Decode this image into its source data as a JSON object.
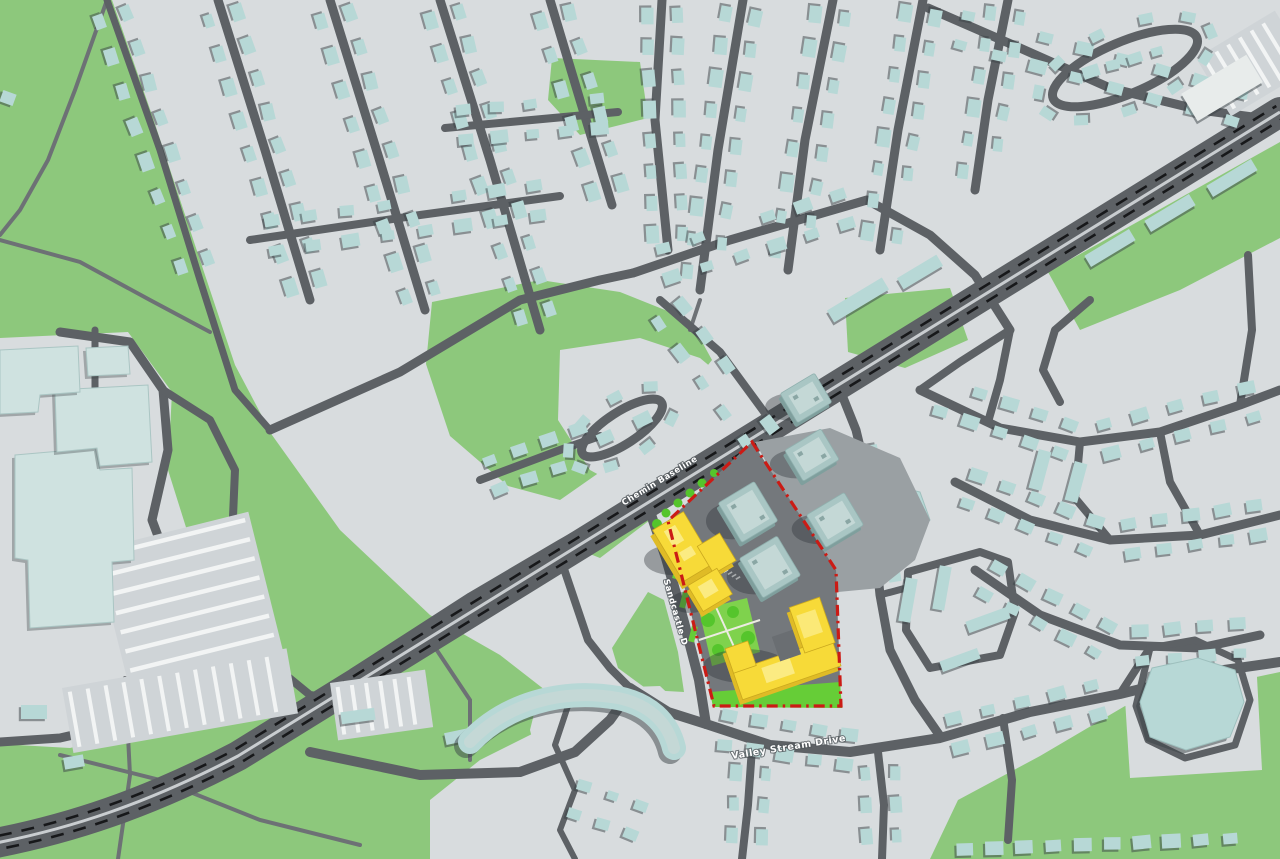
{
  "map": {
    "type": "3d-axonometric-site-plan-map",
    "description": "Suburban context map with development site highlighted by red dashed boundary, proposed buildings in yellow, existing towers in teal",
    "labels": {
      "baseline_road": "Chemin Baseline",
      "sandcastle_drive": "Sandcastle D",
      "valley_stream_drive": "Valley Stream Drive"
    },
    "site": {
      "boundary_style": "red-dash-dot",
      "boundary_color": "#cb1b15",
      "proposed_building_color": "#f7da38",
      "existing_building_color": "#a9c6c4"
    },
    "palette": {
      "base": "#d8dcde",
      "baseShade": "#cfd4d7",
      "green": "#8dc87c",
      "brightGreen": "#66cd37",
      "lawnGreen": "#7fd24d",
      "treeGreen": "#55c52c",
      "road": "#5d6165",
      "path": "#6d7175",
      "house": "#b7d8d6",
      "hospital": "#cfe2e0",
      "tealTop": "#a9c6c4",
      "tealSide": "#7f9f9d",
      "tealInner": "#c4d8d6",
      "yellowTop": "#f7da38",
      "yellowSide": "#dfbb26",
      "yellowLight": "#fbeb82",
      "red": "#cb1b15",
      "laneDash": "#17181a",
      "median": "#c9cdd0",
      "white": "#f2f4f4",
      "siteGround": "#74787c",
      "apron": "#9aa0a3",
      "shadow": "rgba(45,50,54,0.38)",
      "houseShadow": "rgba(58,66,70,0.5)",
      "pathLight": "#ecebe2"
    }
  }
}
